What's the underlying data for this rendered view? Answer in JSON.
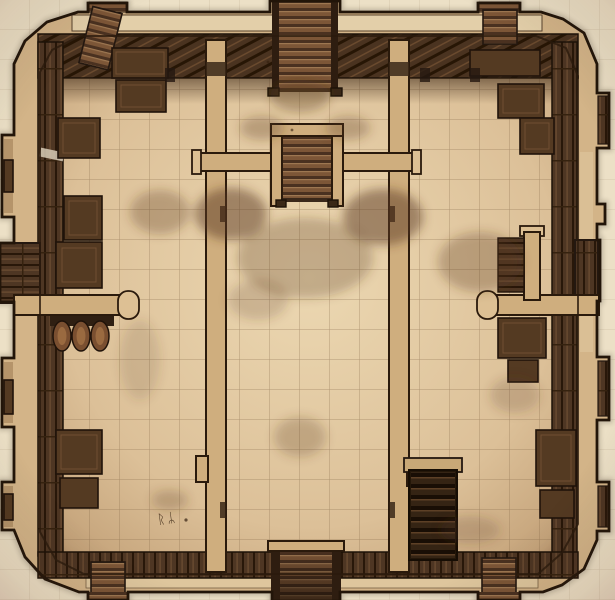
{
  "scene": {
    "type": "top-down dungeon battle map",
    "art_style": "hand-drawn sepia parchment with pencil smudges",
    "grid_cell_px": 30,
    "rooms": [
      {
        "id": "north-landing",
        "desc": "small landing room at top of central corridor between the north and middle staircases"
      },
      {
        "id": "central-hall",
        "desc": "long central hall with gridded stone floor"
      },
      {
        "id": "west-chamber",
        "desc": "large west room lined with dark plank walls and crates, partial partition wall with rounded end"
      },
      {
        "id": "east-chamber",
        "desc": "large east room with crates, shelf alcove and partial partition wall with rounded end"
      },
      {
        "id": "southwest-area",
        "desc": "lower west room with barrel rack under the partition and rune marks scratched on the floor"
      },
      {
        "id": "southeast-area",
        "desc": "lower east room with a dark stair pit beside the corridor wall"
      }
    ],
    "stairs": [
      {
        "id": "north-stair",
        "position": "top center, descends south through the north wall"
      },
      {
        "id": "mid-stair",
        "position": "center, enclosed stairwell below the north landing"
      },
      {
        "id": "south-stair",
        "position": "bottom center, exits through the south wall"
      },
      {
        "id": "northwest-ladder",
        "position": "small tower bump on north wall, west side"
      },
      {
        "id": "northeast-ladder",
        "position": "small tower bump on north wall, east side"
      },
      {
        "id": "southwest-ladder",
        "position": "small tower bump on south wall, west side"
      },
      {
        "id": "southeast-ladder",
        "position": "small tower bump on south wall, east side"
      },
      {
        "id": "stair-pit",
        "position": "southeast chamber, rectangular pit with rungs descending"
      }
    ],
    "furniture": [
      {
        "id": "crate-stack-northwest",
        "count": 5
      },
      {
        "id": "crate-stack-northeast",
        "count": 3
      },
      {
        "id": "crates-west-wall",
        "count": 2
      },
      {
        "id": "barrel-rack-west",
        "barrels": 3
      },
      {
        "id": "shelf-alcove-east",
        "count": 2
      },
      {
        "id": "bench-east-under-partition",
        "count": 2
      },
      {
        "id": "crates-southwest",
        "count": 2
      },
      {
        "id": "crates-southeast-wall",
        "count": 2
      }
    ],
    "walls": [
      "outer bastion wall with chamfered corners and protruding notches on west and east edges",
      "dark timber lining along interior of north, west, east and south walls",
      "two vertical corridor walls framing the central hall",
      "cross wall with central stairwell separating north landing from central hall",
      "partial partition walls with rounded caps on west and east sides"
    ],
    "runes": {
      "text": "ᚱᛦ",
      "position": "southwest floor near the south wall"
    }
  },
  "colors": {
    "parchment": "#ece0c6",
    "wall_tan": "#d3b488",
    "wall_cap_light": "#e8d6b2",
    "outline": "#221509",
    "floor_light": "#ecd8b2",
    "floor_dark": "#c2a077",
    "wood_dark": "#4e3623",
    "plank_line": "#281709",
    "step_light": "#9d7751",
    "grid_line": "#7d6142",
    "smudge": "#5a3a20"
  }
}
